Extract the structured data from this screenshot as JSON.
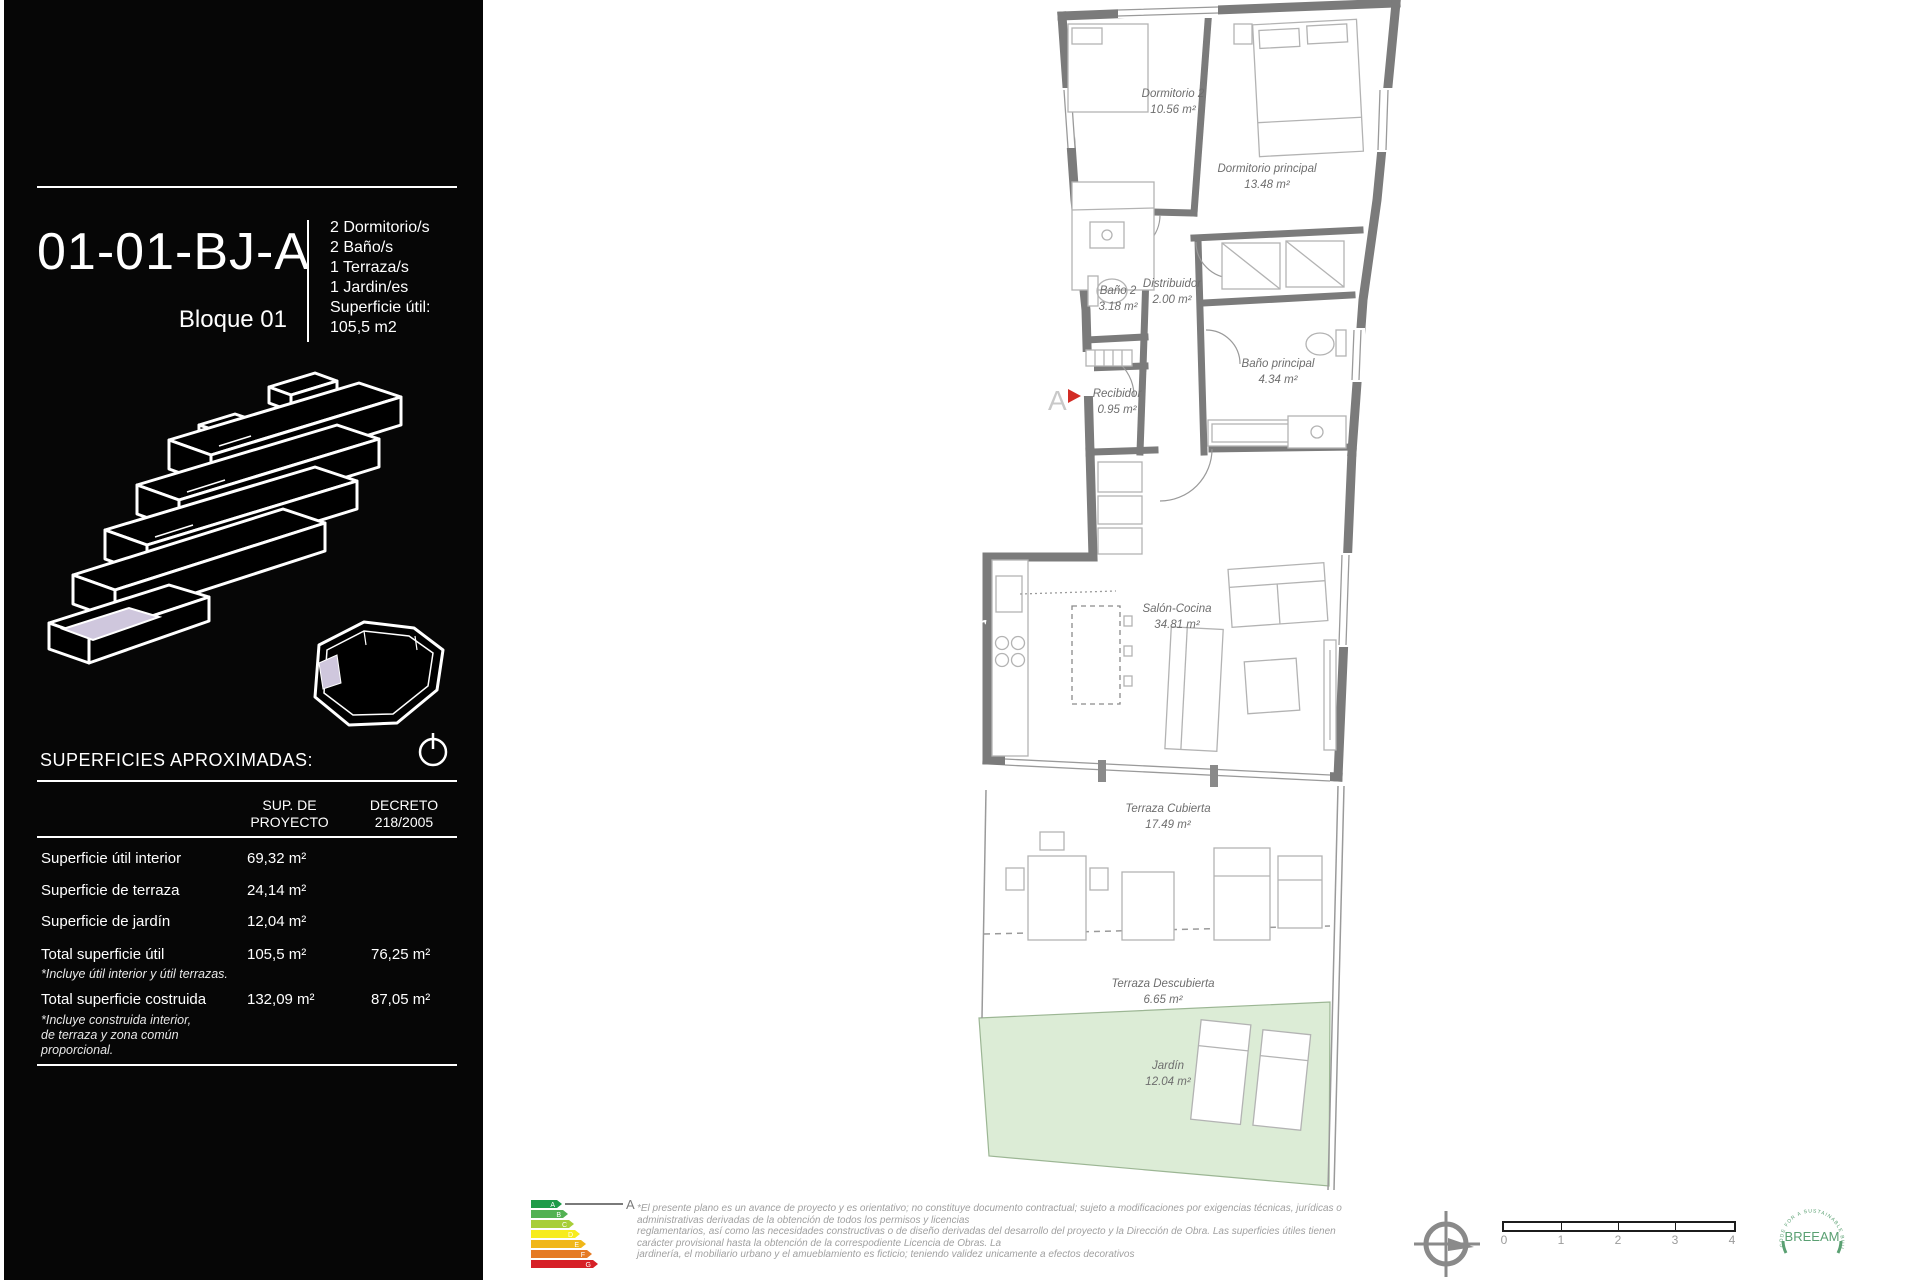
{
  "panel": {
    "unit_code": "01-01-BJ-A",
    "block_label": "Bloque 01",
    "features": [
      "2 Dormitorio/s",
      "2 Baño/s",
      "1 Terraza/s",
      "1 Jardin/es"
    ],
    "useful_label": "Superficie útil:",
    "useful_value": "105,5  m2",
    "surfaces_title": "SUPERFICIES APROXIMADAS:",
    "table": {
      "col_proyecto": [
        "SUP. DE",
        "PROYECTO"
      ],
      "col_decreto": [
        "DECRETO",
        "218/2005"
      ],
      "rows": [
        {
          "label": "Superficie útil interior",
          "proyecto": "69,32  m²",
          "decreto": ""
        },
        {
          "label": "Superficie de terraza",
          "proyecto": "24,14  m²",
          "decreto": ""
        },
        {
          "label": "Superficie de jardín",
          "proyecto": "12,04 m²",
          "decreto": ""
        },
        {
          "label": "Total superficie útil",
          "proyecto": "105,5  m²",
          "decreto": "76,25  m²",
          "notes": [
            "*Incluye útil interior y útil terrazas."
          ]
        },
        {
          "label": "Total superficie costruida",
          "proyecto": "132,09  m²",
          "decreto": "87,05  m²",
          "notes": [
            "*Incluye construida interior,",
            "de terraza y zona común",
            "proporcional."
          ]
        }
      ]
    },
    "highlight_color": "#cfc7dd"
  },
  "plan": {
    "rooms": [
      {
        "name": "Dormitorio 2",
        "area": "10.56 m²"
      },
      {
        "name": "Dormitorio principal",
        "area": "13.48 m²"
      },
      {
        "name": "Baño 2",
        "area": "3.18 m²"
      },
      {
        "name": "Distribuidor",
        "area": "2.00 m²"
      },
      {
        "name": "Baño principal",
        "area": "4.34 m²"
      },
      {
        "name": "Recibidor",
        "area": "0.95 m²"
      },
      {
        "name": "Salón-Cocina",
        "area": "34.81 m²"
      },
      {
        "name": "Terraza Cubierta",
        "area": "17.49 m²"
      },
      {
        "name": "Terraza Descubierta",
        "area": "6.65 m²"
      },
      {
        "name": "Jardín",
        "area": "12.04 m²"
      }
    ],
    "entrance_label": "A",
    "watermark_fragments": [
      "er",
      "rty"
    ],
    "wall_color": "#7b7b7b",
    "garden_color": "#dcecd6",
    "entrance_marker_color": "#d22b24"
  },
  "footer": {
    "energy": {
      "letters": [
        "A",
        "B",
        "C",
        "D",
        "E",
        "F",
        "G"
      ],
      "colors": [
        "#1e9b48",
        "#52b153",
        "#a8ce38",
        "#f7ec1f",
        "#f0b719",
        "#e57b25",
        "#d62027"
      ],
      "pointer_label": "A"
    },
    "disclaimer": [
      "*El presente plano es un avance de proyecto y es orientativo; no constituye documento contractual; sujeto a modificaciones por exigencias técnicas, jurídicas o",
      "administrativas derivadas de la obtención de todos los permisos y licencias",
      "reglamentarios, así como las necesidades constructivas o de diseño derivadas del desarrollo del proyecto y la Dirección de Obra. Las superficies útiles tienen",
      "carácter provisional hasta la obtención de la correspodiente Licencia de Obras. La",
      "jardinería, el mobiliario urbano y el amueblamiento es ficticio; teniendo validez unicamente a efectos decorativos"
    ],
    "scale_ticks": [
      "0",
      "1",
      "2",
      "3",
      "4"
    ],
    "breeam": {
      "center": "BREEAM",
      "ring": "CODE FOR A SUSTAINABLE BUILT ENVIRONMENT"
    }
  }
}
